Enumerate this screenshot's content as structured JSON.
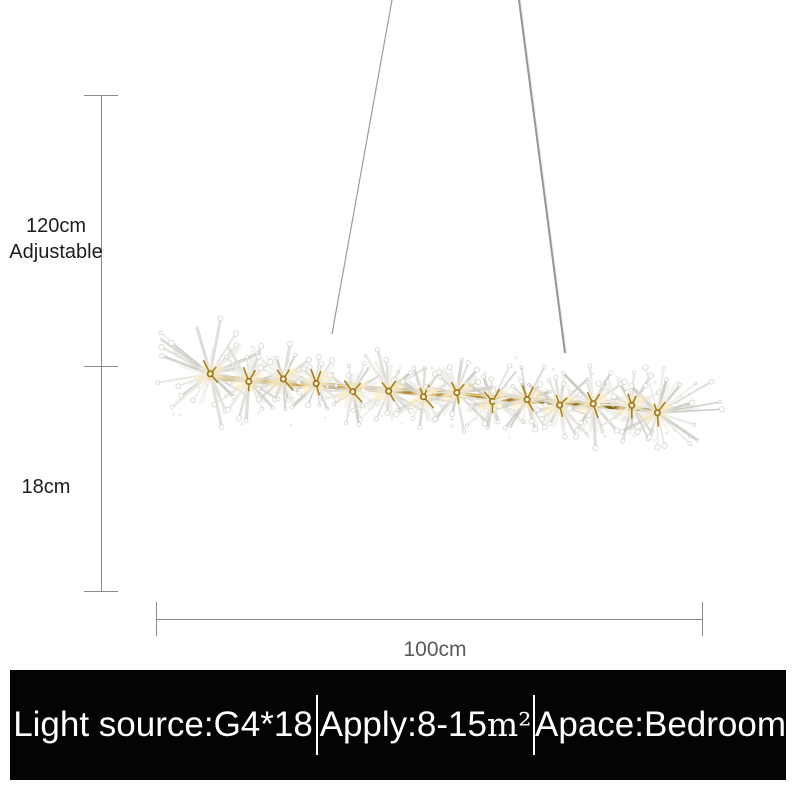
{
  "annotations": {
    "drop_height": "120cm",
    "drop_height_note": "Adjustable",
    "body_height": "18cm",
    "body_width": "100cm"
  },
  "spec_bar": {
    "items": [
      {
        "text": "Light source:G4*18"
      },
      {
        "text": "Apply:8-15",
        "unit": "m²"
      },
      {
        "text": "Apace:Bedroom"
      }
    ]
  },
  "colors": {
    "background": "#ffffff",
    "spec_bar_background": "#040404",
    "spec_bar_text": "#ffffff",
    "dimension_line": "#8a8a8a",
    "dimension_label_text": "#1d1d1d",
    "width_label_text": "#5a5a5a",
    "chandelier_gold": "#b0862a",
    "crystal_gray": "#d7d5cf",
    "light_glow": "#ffedba",
    "wire_gray": "#9b9b9b"
  }
}
